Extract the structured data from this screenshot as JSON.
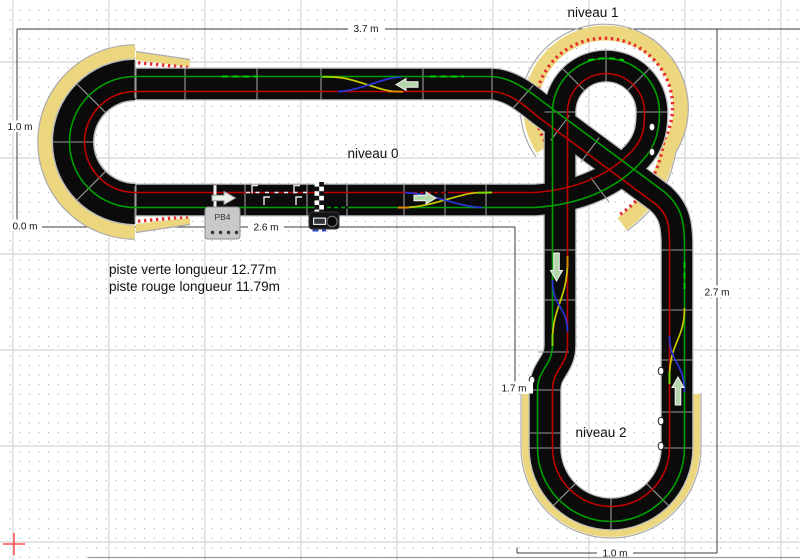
{
  "app": "slot-track-plan-editor",
  "labels": {
    "niveau0": "niveau 0",
    "niveau1": "niveau 1",
    "niveau2": "niveau 2",
    "piste_line1": "piste verte longueur 12.77m",
    "piste_line2": "piste rouge longueur 11.79m"
  },
  "dimensions": {
    "top": "3.7 m",
    "left": "1.0 m",
    "origin": "0.0 m",
    "start_straight": "2.6 m",
    "right": "2.7 m",
    "level2_left": "1.7 m",
    "bottom": "1.0 m"
  },
  "devices": {
    "power_base_label": "PB4",
    "lap_counter": "lap-counter-unit",
    "start_line": "start-finish-line",
    "checker_strip": "checkered-sensor-strip"
  },
  "icons": {
    "direction_arrows": [
      "arrow-left-icon",
      "arrow-right-icon",
      "arrow-down-icon",
      "arrow-up-icon",
      "start-arrow-right-icon"
    ],
    "origin_marker": "origin-cross-icon",
    "connector_markers": "o-clip-marker"
  },
  "colors": {
    "background": "#FFFFFF",
    "grid_major": "#CBCBCB",
    "grid_dot": "#B5B5B5",
    "track": "#0B0B0B",
    "track_edge": "#BDBDBD",
    "lane_green": "#00A000",
    "lane_green_bright": "#00CF00",
    "lane_red": "#C00000",
    "curb_fill": "#EDD77E",
    "curb_dot": "#E62E2E",
    "piece_divider": "#9A9A9A",
    "changer_blue": "#2B35D8",
    "changer_yellow": "#C9C900",
    "changer_orange": "#E08800",
    "changer_bright": "#7FD800",
    "arrow_fill": "#B5D6AD",
    "dimension_line": "#3C3C3C",
    "origin_cross": "#FF5050"
  }
}
